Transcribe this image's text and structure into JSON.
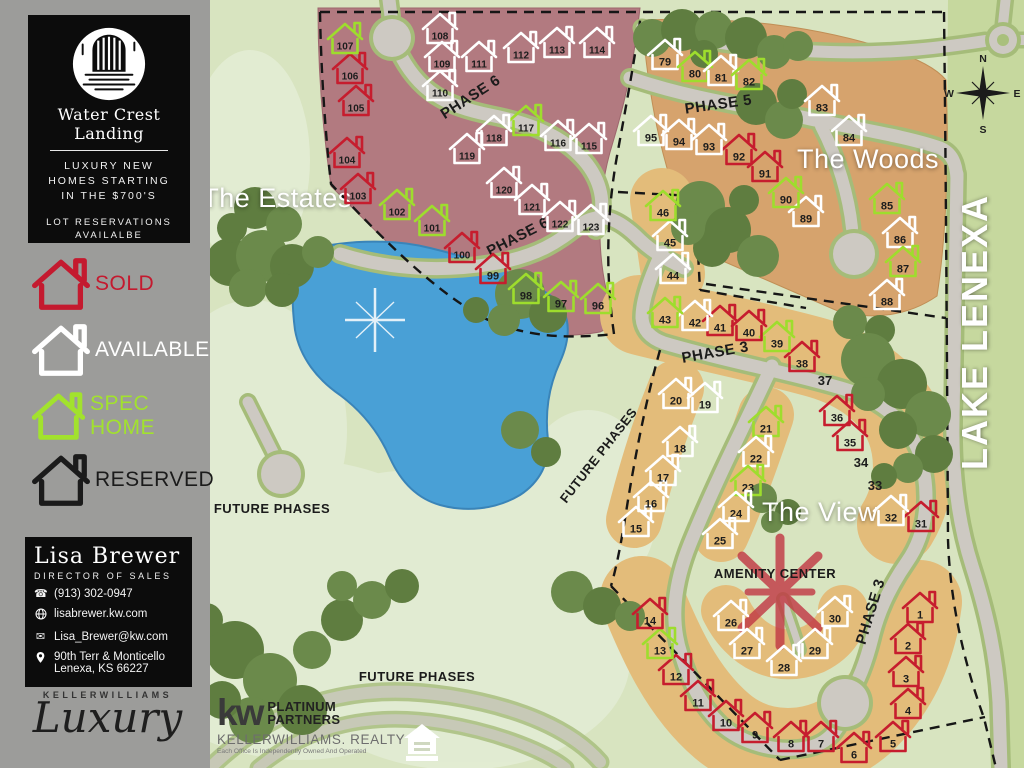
{
  "sidebar": {
    "logo_title": "Water Crest Landing",
    "tagline_lines": [
      "LUXURY NEW",
      "HOMES STARTING",
      "IN THE $700'S"
    ],
    "reservation_lines": [
      "LOT RESERVATIONS",
      "AVAILALBE"
    ],
    "legend": [
      {
        "key": "sold",
        "label": "SOLD",
        "color": "#c41a2f"
      },
      {
        "key": "available",
        "label": "AVAILABLE",
        "color": "#ffffff"
      },
      {
        "key": "spec",
        "label": "SPEC HOME",
        "color": "#a2e22d"
      },
      {
        "key": "reserved",
        "label": "RESERVED",
        "color": "#1b1b1b"
      }
    ],
    "agent": {
      "name": "Lisa Brewer",
      "title": "DIRECTOR OF SALES",
      "phone": "(913) 302-0947",
      "website": "lisabrewer.kw.com",
      "email": "Lisa_Brewer@kw.com",
      "address_line1": "90th Terr & Monticello",
      "address_line2": "Lenexa, KS 66227"
    },
    "kw_luxury": {
      "brand": "KELLERWILLIAMS",
      "script": "Luxury"
    }
  },
  "map": {
    "footer_brand": {
      "kw": "kw",
      "brand_lines": [
        "PLATINUM",
        "PARTNERS"
      ],
      "realty": "KELLERWILLIAMS. REALTY",
      "disclaimer": "Each Office Is Independently Owned And Operated"
    },
    "compass": {
      "n": "N",
      "s": "S",
      "e": "E",
      "w": "W"
    },
    "area_labels": [
      {
        "text": "The Estates",
        "x": 277,
        "y": 207,
        "rot": 0,
        "size": 27,
        "color": "#ffffff",
        "weight": 400,
        "ls": 0.5
      },
      {
        "text": "The Woods",
        "x": 868,
        "y": 168,
        "rot": 0,
        "size": 27,
        "color": "#ffffff",
        "weight": 400,
        "ls": 0.5
      },
      {
        "text": "The View",
        "x": 820,
        "y": 521,
        "rot": 0,
        "size": 27,
        "color": "#ffffff",
        "weight": 400,
        "ls": 0.5
      },
      {
        "text": "LAKE LENEXA",
        "x": 987,
        "y": 332,
        "rot": -90,
        "size": 36,
        "color": "#ffffff",
        "weight": 600,
        "ls": 2
      }
    ],
    "road_labels": [
      {
        "text": "PHASE 6",
        "x": 473,
        "y": 101,
        "rot": -33,
        "size": 15
      },
      {
        "text": "PHASE 6",
        "x": 520,
        "y": 241,
        "rot": -27,
        "size": 15
      },
      {
        "text": "PHASE 5",
        "x": 719,
        "y": 109,
        "rot": -8,
        "size": 15
      },
      {
        "text": "PHASE 3",
        "x": 716,
        "y": 357,
        "rot": -10,
        "size": 15
      },
      {
        "text": "PHASE 3",
        "x": 875,
        "y": 613,
        "rot": -73,
        "size": 15
      },
      {
        "text": "FUTURE PHASES",
        "x": 272,
        "y": 513,
        "rot": 0,
        "size": 13
      },
      {
        "text": "FUTURE PHASES",
        "x": 602,
        "y": 458,
        "rot": -52,
        "size": 13
      },
      {
        "text": "FUTURE PHASES",
        "x": 417,
        "y": 681,
        "rot": 0,
        "size": 13
      },
      {
        "text": "AMENITY CENTER",
        "x": 775,
        "y": 578,
        "rot": 0,
        "size": 13
      }
    ],
    "status_colors": {
      "sold": "#c61d2e",
      "available": "#ffffff",
      "spec": "#9edd2d",
      "reserved": "#1b1b1b",
      "number": "#1d1d1d"
    },
    "lots": [
      {
        "n": 1,
        "x": 920,
        "y": 607,
        "s": "sold"
      },
      {
        "n": 2,
        "x": 908,
        "y": 638,
        "s": "sold"
      },
      {
        "n": 3,
        "x": 906,
        "y": 671,
        "s": "sold"
      },
      {
        "n": 4,
        "x": 908,
        "y": 703,
        "s": "sold"
      },
      {
        "n": 5,
        "x": 893,
        "y": 736,
        "s": "sold"
      },
      {
        "n": 6,
        "x": 854,
        "y": 747,
        "s": "sold"
      },
      {
        "n": 7,
        "x": 821,
        "y": 736,
        "s": "sold"
      },
      {
        "n": 8,
        "x": 791,
        "y": 736,
        "s": "sold"
      },
      {
        "n": 9,
        "x": 755,
        "y": 727,
        "s": "sold"
      },
      {
        "n": 10,
        "x": 726,
        "y": 715,
        "s": "sold"
      },
      {
        "n": 11,
        "x": 698,
        "y": 695,
        "s": "sold"
      },
      {
        "n": 12,
        "x": 676,
        "y": 669,
        "s": "sold"
      },
      {
        "n": 13,
        "x": 660,
        "y": 643,
        "s": "spec"
      },
      {
        "n": 14,
        "x": 650,
        "y": 613,
        "s": "sold"
      },
      {
        "n": 15,
        "x": 636,
        "y": 521,
        "s": "available"
      },
      {
        "n": 16,
        "x": 651,
        "y": 496,
        "s": "available"
      },
      {
        "n": 17,
        "x": 663,
        "y": 470,
        "s": "available"
      },
      {
        "n": 18,
        "x": 680,
        "y": 441,
        "s": "available"
      },
      {
        "n": 19,
        "x": 705,
        "y": 397,
        "s": "available"
      },
      {
        "n": 20,
        "x": 676,
        "y": 393,
        "s": "available"
      },
      {
        "n": 21,
        "x": 766,
        "y": 421,
        "s": "spec"
      },
      {
        "n": 22,
        "x": 756,
        "y": 451,
        "s": "available"
      },
      {
        "n": 23,
        "x": 748,
        "y": 480,
        "s": "spec"
      },
      {
        "n": 24,
        "x": 736,
        "y": 506,
        "s": "available"
      },
      {
        "n": 25,
        "x": 720,
        "y": 533,
        "s": "available"
      },
      {
        "n": 26,
        "x": 731,
        "y": 615,
        "s": "available"
      },
      {
        "n": 27,
        "x": 747,
        "y": 643,
        "s": "available"
      },
      {
        "n": 28,
        "x": 784,
        "y": 660,
        "s": "available"
      },
      {
        "n": 29,
        "x": 815,
        "y": 643,
        "s": "available"
      },
      {
        "n": 30,
        "x": 835,
        "y": 611,
        "s": "available"
      },
      {
        "n": 31,
        "x": 921,
        "y": 516,
        "s": "sold"
      },
      {
        "n": 32,
        "x": 891,
        "y": 510,
        "s": "available"
      },
      {
        "n": 33,
        "x": 875,
        "y": 486,
        "s": "none"
      },
      {
        "n": 34,
        "x": 861,
        "y": 463,
        "s": "none"
      },
      {
        "n": 35,
        "x": 850,
        "y": 435,
        "s": "sold"
      },
      {
        "n": 36,
        "x": 837,
        "y": 410,
        "s": "sold"
      },
      {
        "n": 37,
        "x": 825,
        "y": 381,
        "s": "none"
      },
      {
        "n": 38,
        "x": 802,
        "y": 356,
        "s": "sold"
      },
      {
        "n": 39,
        "x": 777,
        "y": 336,
        "s": "spec"
      },
      {
        "n": 40,
        "x": 749,
        "y": 325,
        "s": "sold"
      },
      {
        "n": 41,
        "x": 720,
        "y": 320,
        "s": "sold"
      },
      {
        "n": 42,
        "x": 695,
        "y": 315,
        "s": "available"
      },
      {
        "n": 43,
        "x": 665,
        "y": 312,
        "s": "spec"
      },
      {
        "n": 44,
        "x": 673,
        "y": 268,
        "s": "available"
      },
      {
        "n": 45,
        "x": 670,
        "y": 235,
        "s": "available"
      },
      {
        "n": 46,
        "x": 663,
        "y": 205,
        "s": "spec"
      },
      {
        "n": 79,
        "x": 665,
        "y": 54,
        "s": "available"
      },
      {
        "n": 80,
        "x": 695,
        "y": 66,
        "s": "spec"
      },
      {
        "n": 81,
        "x": 721,
        "y": 70,
        "s": "available"
      },
      {
        "n": 82,
        "x": 749,
        "y": 74,
        "s": "spec"
      },
      {
        "n": 83,
        "x": 822,
        "y": 100,
        "s": "available"
      },
      {
        "n": 84,
        "x": 849,
        "y": 130,
        "s": "available"
      },
      {
        "n": 85,
        "x": 887,
        "y": 198,
        "s": "spec"
      },
      {
        "n": 86,
        "x": 900,
        "y": 232,
        "s": "available"
      },
      {
        "n": 87,
        "x": 903,
        "y": 261,
        "s": "spec"
      },
      {
        "n": 88,
        "x": 887,
        "y": 294,
        "s": "available"
      },
      {
        "n": 89,
        "x": 806,
        "y": 211,
        "s": "available"
      },
      {
        "n": 90,
        "x": 786,
        "y": 192,
        "s": "spec"
      },
      {
        "n": 91,
        "x": 765,
        "y": 166,
        "s": "sold"
      },
      {
        "n": 92,
        "x": 739,
        "y": 149,
        "s": "sold"
      },
      {
        "n": 93,
        "x": 709,
        "y": 139,
        "s": "available"
      },
      {
        "n": 94,
        "x": 679,
        "y": 134,
        "s": "available"
      },
      {
        "n": 95,
        "x": 651,
        "y": 130,
        "s": "available"
      },
      {
        "n": 96,
        "x": 598,
        "y": 298,
        "s": "spec"
      },
      {
        "n": 97,
        "x": 561,
        "y": 296,
        "s": "spec"
      },
      {
        "n": 98,
        "x": 526,
        "y": 288,
        "s": "spec"
      },
      {
        "n": 99,
        "x": 493,
        "y": 268,
        "s": "sold"
      },
      {
        "n": 100,
        "x": 462,
        "y": 247,
        "s": "sold"
      },
      {
        "n": 101,
        "x": 432,
        "y": 220,
        "s": "spec"
      },
      {
        "n": 102,
        "x": 397,
        "y": 204,
        "s": "spec"
      },
      {
        "n": 103,
        "x": 358,
        "y": 188,
        "s": "sold"
      },
      {
        "n": 104,
        "x": 347,
        "y": 152,
        "s": "sold"
      },
      {
        "n": 105,
        "x": 356,
        "y": 100,
        "s": "sold"
      },
      {
        "n": 106,
        "x": 350,
        "y": 68,
        "s": "sold"
      },
      {
        "n": 107,
        "x": 345,
        "y": 38,
        "s": "spec"
      },
      {
        "n": 108,
        "x": 440,
        "y": 28,
        "s": "available"
      },
      {
        "n": 109,
        "x": 442,
        "y": 56,
        "s": "available"
      },
      {
        "n": 110,
        "x": 440,
        "y": 85,
        "s": "available"
      },
      {
        "n": 111,
        "x": 479,
        "y": 56,
        "s": "available"
      },
      {
        "n": 112,
        "x": 521,
        "y": 47,
        "s": "available"
      },
      {
        "n": 113,
        "x": 557,
        "y": 42,
        "s": "available"
      },
      {
        "n": 114,
        "x": 597,
        "y": 42,
        "s": "available"
      },
      {
        "n": 115,
        "x": 589,
        "y": 138,
        "s": "available"
      },
      {
        "n": 116,
        "x": 558,
        "y": 135,
        "s": "available"
      },
      {
        "n": 117,
        "x": 526,
        "y": 120,
        "s": "spec"
      },
      {
        "n": 118,
        "x": 494,
        "y": 130,
        "s": "available"
      },
      {
        "n": 119,
        "x": 467,
        "y": 148,
        "s": "available"
      },
      {
        "n": 120,
        "x": 504,
        "y": 182,
        "s": "available"
      },
      {
        "n": 121,
        "x": 532,
        "y": 199,
        "s": "available"
      },
      {
        "n": 122,
        "x": 560,
        "y": 216,
        "s": "available"
      },
      {
        "n": 123,
        "x": 591,
        "y": 219,
        "s": "available"
      }
    ]
  },
  "colors": {
    "sidebar_bg": "#9c9c9a",
    "panel_bg": "#0c0c0c",
    "grass": "#d8e4c0",
    "grass_light": "#e3ecd4",
    "lake_strip": "#c6d89e",
    "estates_fill": "#b27a80",
    "woods_fill": "#d6a36d",
    "view_fill": "#e3bc7a",
    "lake": "#49a0d6",
    "road": "#cdc9c2",
    "road_edge": "#a5bc79",
    "tree_a": "#5f7d40",
    "tree_b": "#6b8a4b",
    "boundary": "#161616",
    "amenity_star": "#c13a45"
  }
}
